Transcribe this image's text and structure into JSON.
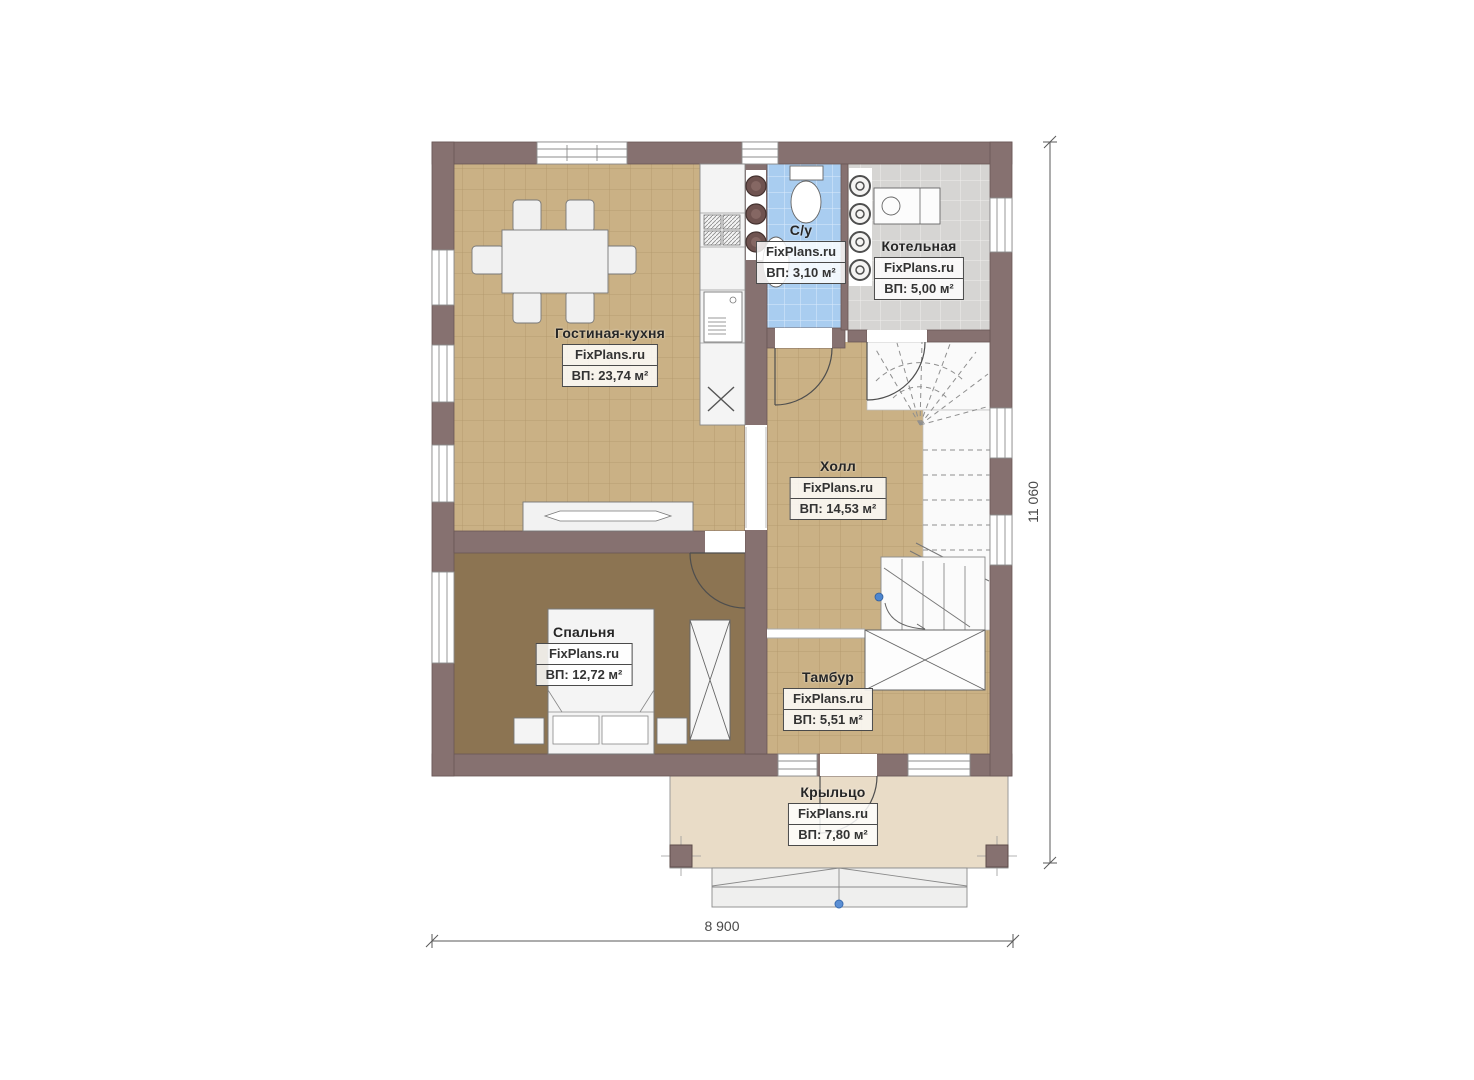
{
  "plan": {
    "brand_watermark": "FixPlans.ru",
    "rooms": [
      {
        "id": "living_kitchen",
        "name": "Гостиная-кухня",
        "brand": "FixPlans.ru",
        "area_label": "ВП: 23,74 м²"
      },
      {
        "id": "bathroom",
        "name": "С/у",
        "brand": "FixPlans.ru",
        "area_label": "ВП: 3,10 м²"
      },
      {
        "id": "boiler_room",
        "name": "Котельная",
        "brand": "FixPlans.ru",
        "area_label": "ВП: 5,00 м²"
      },
      {
        "id": "hall",
        "name": "Холл",
        "brand": "FixPlans.ru",
        "area_label": "ВП: 14,53 м²"
      },
      {
        "id": "bedroom",
        "name": "Спальня",
        "brand": "FixPlans.ru",
        "area_label": "ВП: 12,72 м²"
      },
      {
        "id": "vestibule",
        "name": "Тамбур",
        "brand": "FixPlans.ru",
        "area_label": "ВП: 5,51 м²"
      },
      {
        "id": "porch",
        "name": "Крыльцо",
        "brand": "FixPlans.ru",
        "area_label": "ВП: 7,80 м²"
      }
    ],
    "dimensions": {
      "bottom_width": "8 900",
      "right_height": "11 060"
    },
    "colors": {
      "wall": "#867170",
      "floor_tile": "#cab185",
      "bedroom_floor": "#8c7452",
      "bathroom_tile": "#a9cdf0",
      "boiler_tile": "#d6d5d3",
      "porch": "#e9dcc7"
    }
  }
}
